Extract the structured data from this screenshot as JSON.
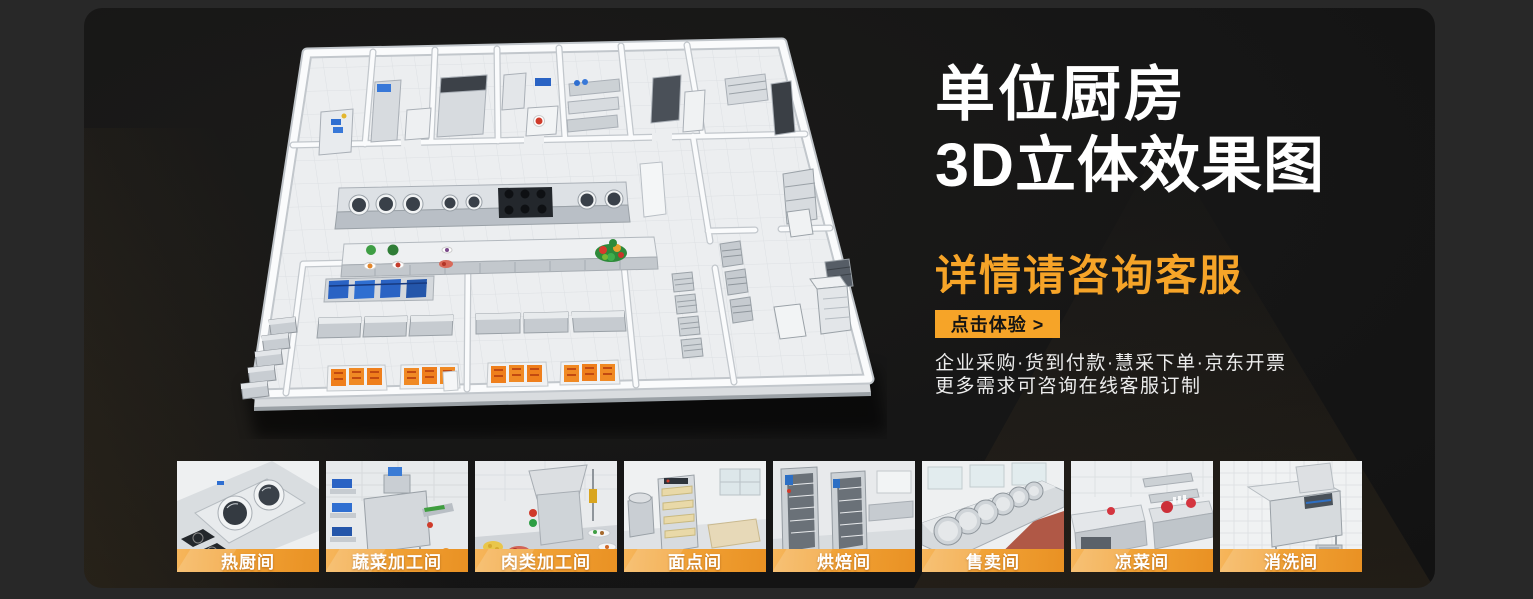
{
  "theme": {
    "page_bg": "#282828",
    "panel_bg": "#161616",
    "accent": "#F6A428",
    "label_band_start": "#F5B054",
    "label_band_end": "#EA9323"
  },
  "hero": {
    "title_line1": "单位厨房",
    "title_line2": "3D立体效果图",
    "subtitle": "详情请咨询客服",
    "cta_label": "点击体验 >",
    "info_line1": "企业采购·货到付款·慧采下单·京东开票",
    "info_line2": "更多需求可咨询在线客服订制"
  },
  "floorplan": {
    "label": "单位厨房3D立体效果图"
  },
  "gallery": {
    "items": [
      {
        "label": "热厨间"
      },
      {
        "label": "蔬菜加工间"
      },
      {
        "label": "肉类加工间"
      },
      {
        "label": "面点间"
      },
      {
        "label": "烘焙间"
      },
      {
        "label": "售卖间"
      },
      {
        "label": "凉菜间"
      },
      {
        "label": "消洗间"
      }
    ]
  }
}
